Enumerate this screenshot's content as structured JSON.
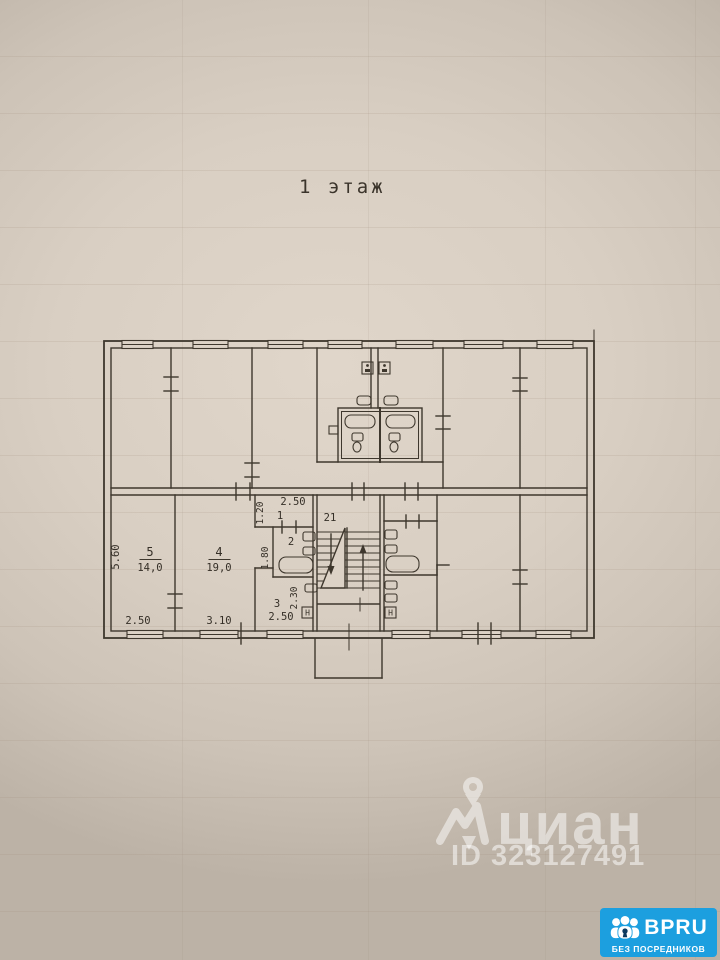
{
  "plan": {
    "title": "1 этаж",
    "room5": {
      "number": "5",
      "area": "14,0",
      "height": "5.60",
      "width": "2.50"
    },
    "room4": {
      "number": "4",
      "area": "19,0",
      "width": "3.10"
    },
    "hall": {
      "number": "1",
      "width": "2.50",
      "height": "1.20"
    },
    "bath": {
      "number": "2",
      "height": "1.80"
    },
    "kitchen": {
      "number": "3",
      "height": "2.30",
      "width": "2.50"
    },
    "stair": {
      "number": "21"
    },
    "hatch_left": "Н",
    "hatch_right": "Н"
  },
  "watermark": {
    "brand": "циан",
    "listing_id": "ID 323127491"
  },
  "badge": {
    "brand": "BPRU",
    "tagline": "БЕЗ ПОСРЕДНИКОВ"
  },
  "colors": {
    "paper": "#d9cfc3",
    "ink": "#3e372d",
    "badge_blue": "#1c9fdf",
    "watermark": "#ffffff"
  }
}
